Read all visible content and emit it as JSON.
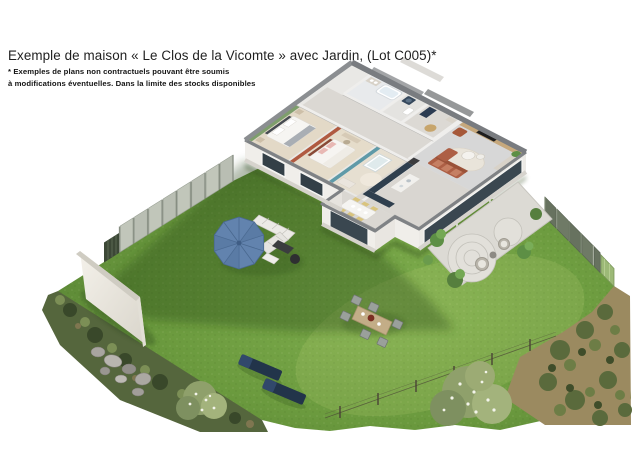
{
  "header": {
    "title": "Exemple de maison « Le Clos de la Vicomte » avec Jardin, (Lot C005)*",
    "disclaimer_line1": "* Exemples de plans non contractuels pouvant être soumis",
    "disclaimer_line2": "à modifications éventuelles. Dans la limite des stocks disponibles"
  },
  "scene": {
    "type": "3d-floorplan-garden-render",
    "house_lot": "C005",
    "elements": [
      "house-cutaway",
      "garden-lawn",
      "patio",
      "parasol",
      "outdoor-lounge-set",
      "sun-loungers",
      "outdoor-dining-set",
      "garden-wall",
      "rocks",
      "fence-left",
      "fence-right",
      "gate",
      "bushes",
      "scrub-border",
      "wire-fence"
    ],
    "rooms": [
      "bedroom-green",
      "bedroom-red",
      "nursery-teal",
      "bathroom",
      "laundry-wc",
      "entry",
      "kitchen",
      "living-room",
      "dining-area"
    ]
  },
  "colors": {
    "lawn_light": "#7fae4e",
    "lawn_mid": "#6b9a3e",
    "lawn_dark": "#4e7530",
    "parasol_blue": "#6283ae",
    "accent_green_wall": "#7e9e6c",
    "accent_red_wall": "#b05a40",
    "accent_teal_wall": "#5f9aa8",
    "sofa_terracotta": "#ad5f45",
    "tv_wall_wood": "#c6a87c",
    "kitchen_navy": "#2f3f4e",
    "lounger_navy": "#22344a",
    "fence_left_grey": "#b9beb3",
    "fence_right_green": "#67725f",
    "gate_green": "#9cb977",
    "patio_concrete": "#dcdad4",
    "garden_wall_white": "#f1eee7"
  }
}
